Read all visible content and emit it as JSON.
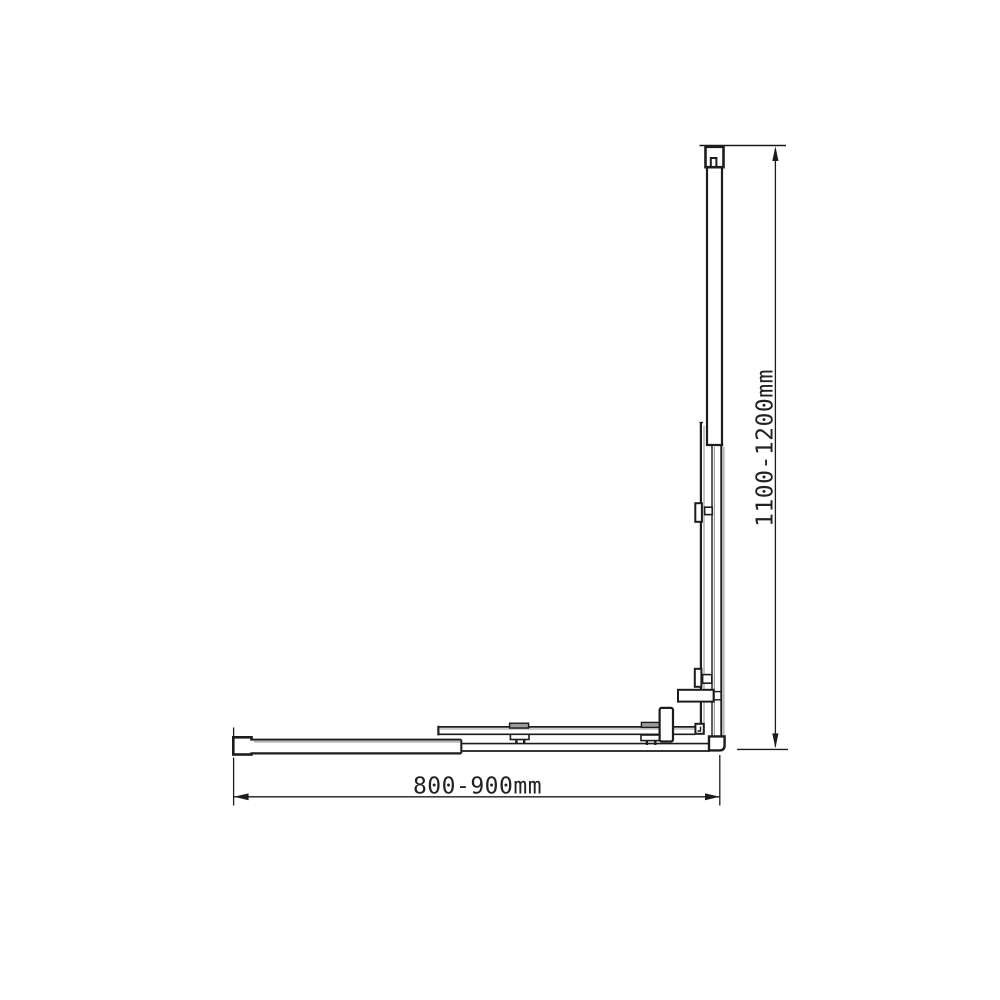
{
  "dimensions": {
    "width": {
      "label": "800-900mm"
    },
    "height": {
      "label": "1100-1200mm"
    }
  },
  "colors": {
    "line": "#1c1c1c",
    "shade": "#9c9c9c",
    "background": "#ffffff",
    "text": "#222222"
  }
}
